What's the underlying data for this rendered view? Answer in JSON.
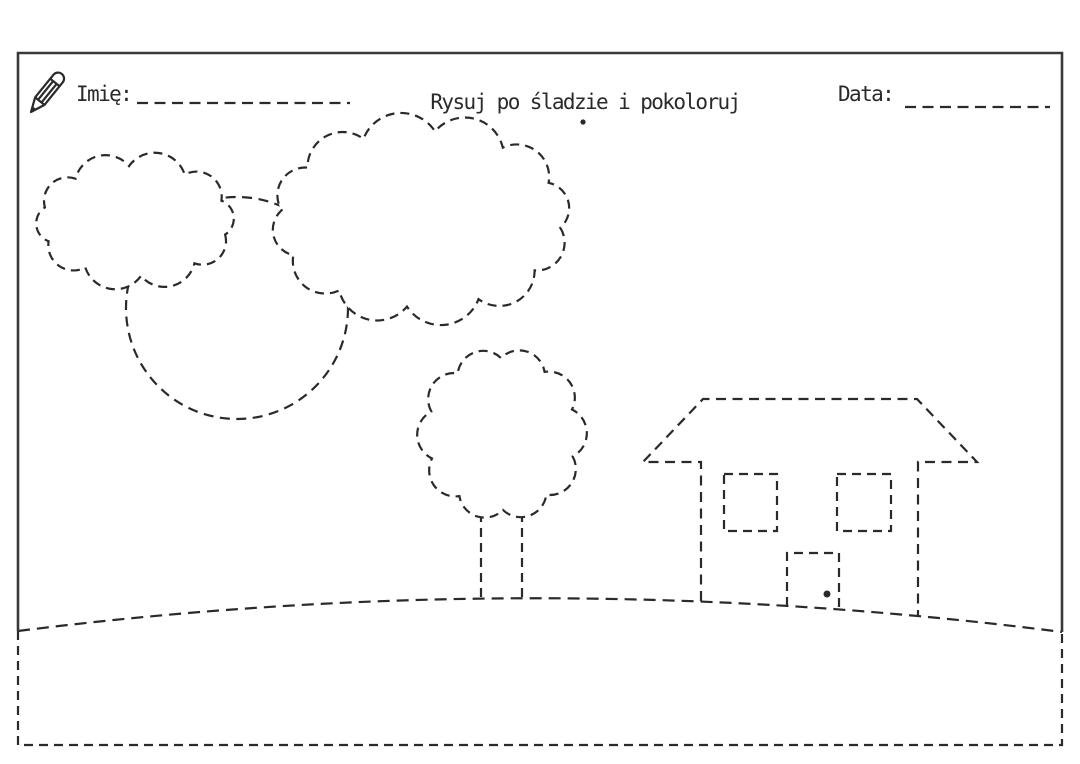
{
  "document": {
    "name_label": "Imię:",
    "title": "Rysuj po śladzie i pokoloruj",
    "date_label": "Data:"
  },
  "style": {
    "ink_color": "#2a2a2a",
    "frame_color": "#3a3a3a",
    "paper_color": "#ffffff"
  },
  "scene": {
    "icons": [
      "pencil-icon",
      "doorknob-dot",
      "title-dot"
    ],
    "traceable_elements": [
      "small-cloud",
      "large-cloud",
      "sun-circle",
      "tree-crown",
      "tree-trunk",
      "house-roof",
      "house-walls",
      "house-window-left",
      "house-window-right",
      "house-door",
      "hill-ground-line",
      "underground-dashed-frame"
    ],
    "write_in_fields": [
      "name-write-line",
      "date-write-line"
    ]
  }
}
